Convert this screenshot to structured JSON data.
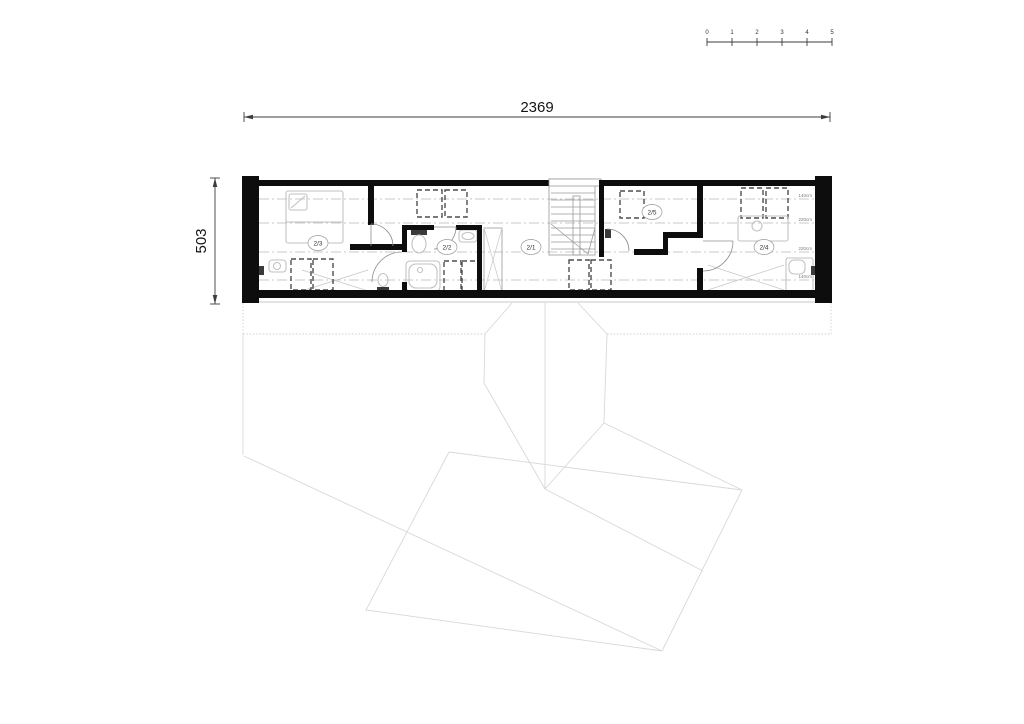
{
  "drawing": {
    "dimension_width": "2369",
    "dimension_height": "503",
    "scale_bar": {
      "labels": [
        "0",
        "1",
        "2",
        "3",
        "4",
        "5"
      ]
    },
    "rooms": [
      {
        "label": "2/3"
      },
      {
        "label": "2/2"
      },
      {
        "label": "2/1"
      },
      {
        "label": "2/5"
      },
      {
        "label": "2/4"
      }
    ],
    "height_annotations": [
      {
        "label": "140cm"
      },
      {
        "label": "220cm"
      },
      {
        "label": "220cm"
      },
      {
        "label": "140cm"
      }
    ],
    "colors": {
      "wall": "#0d0d0d",
      "furniture_light": "#c2c2c2",
      "furniture_dashed": "#4f4f4f",
      "roof_faint": "#d8d8d8"
    }
  }
}
